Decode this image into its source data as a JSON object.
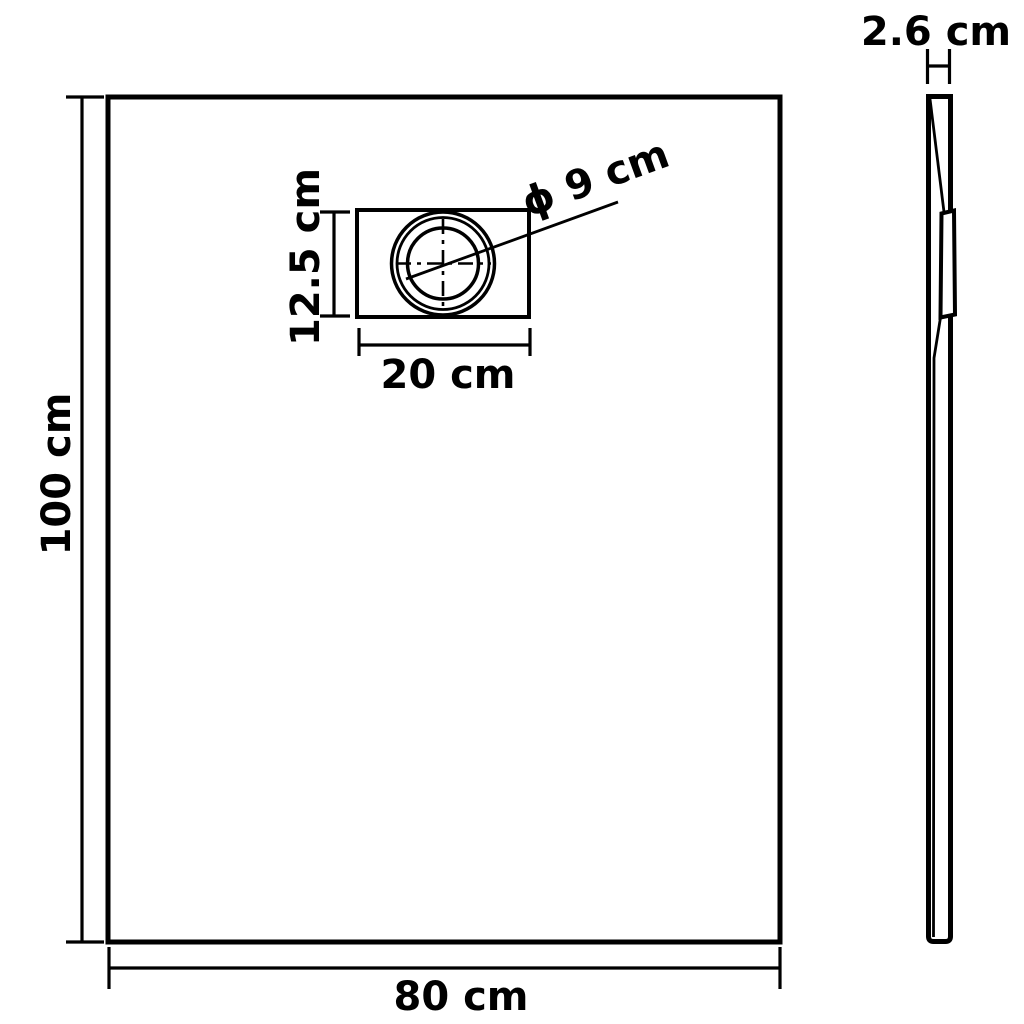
{
  "diagram": {
    "colors": {
      "line": "#000000",
      "background": "#ffffff"
    },
    "front_view": {
      "height_label": "100 cm",
      "width_label": "80 cm",
      "drain": {
        "height_label": "12.5 cm",
        "width_label": "20 cm",
        "diameter_label": "ϕ 9 cm"
      }
    },
    "side_view": {
      "thickness_label": "2.6 cm"
    }
  }
}
